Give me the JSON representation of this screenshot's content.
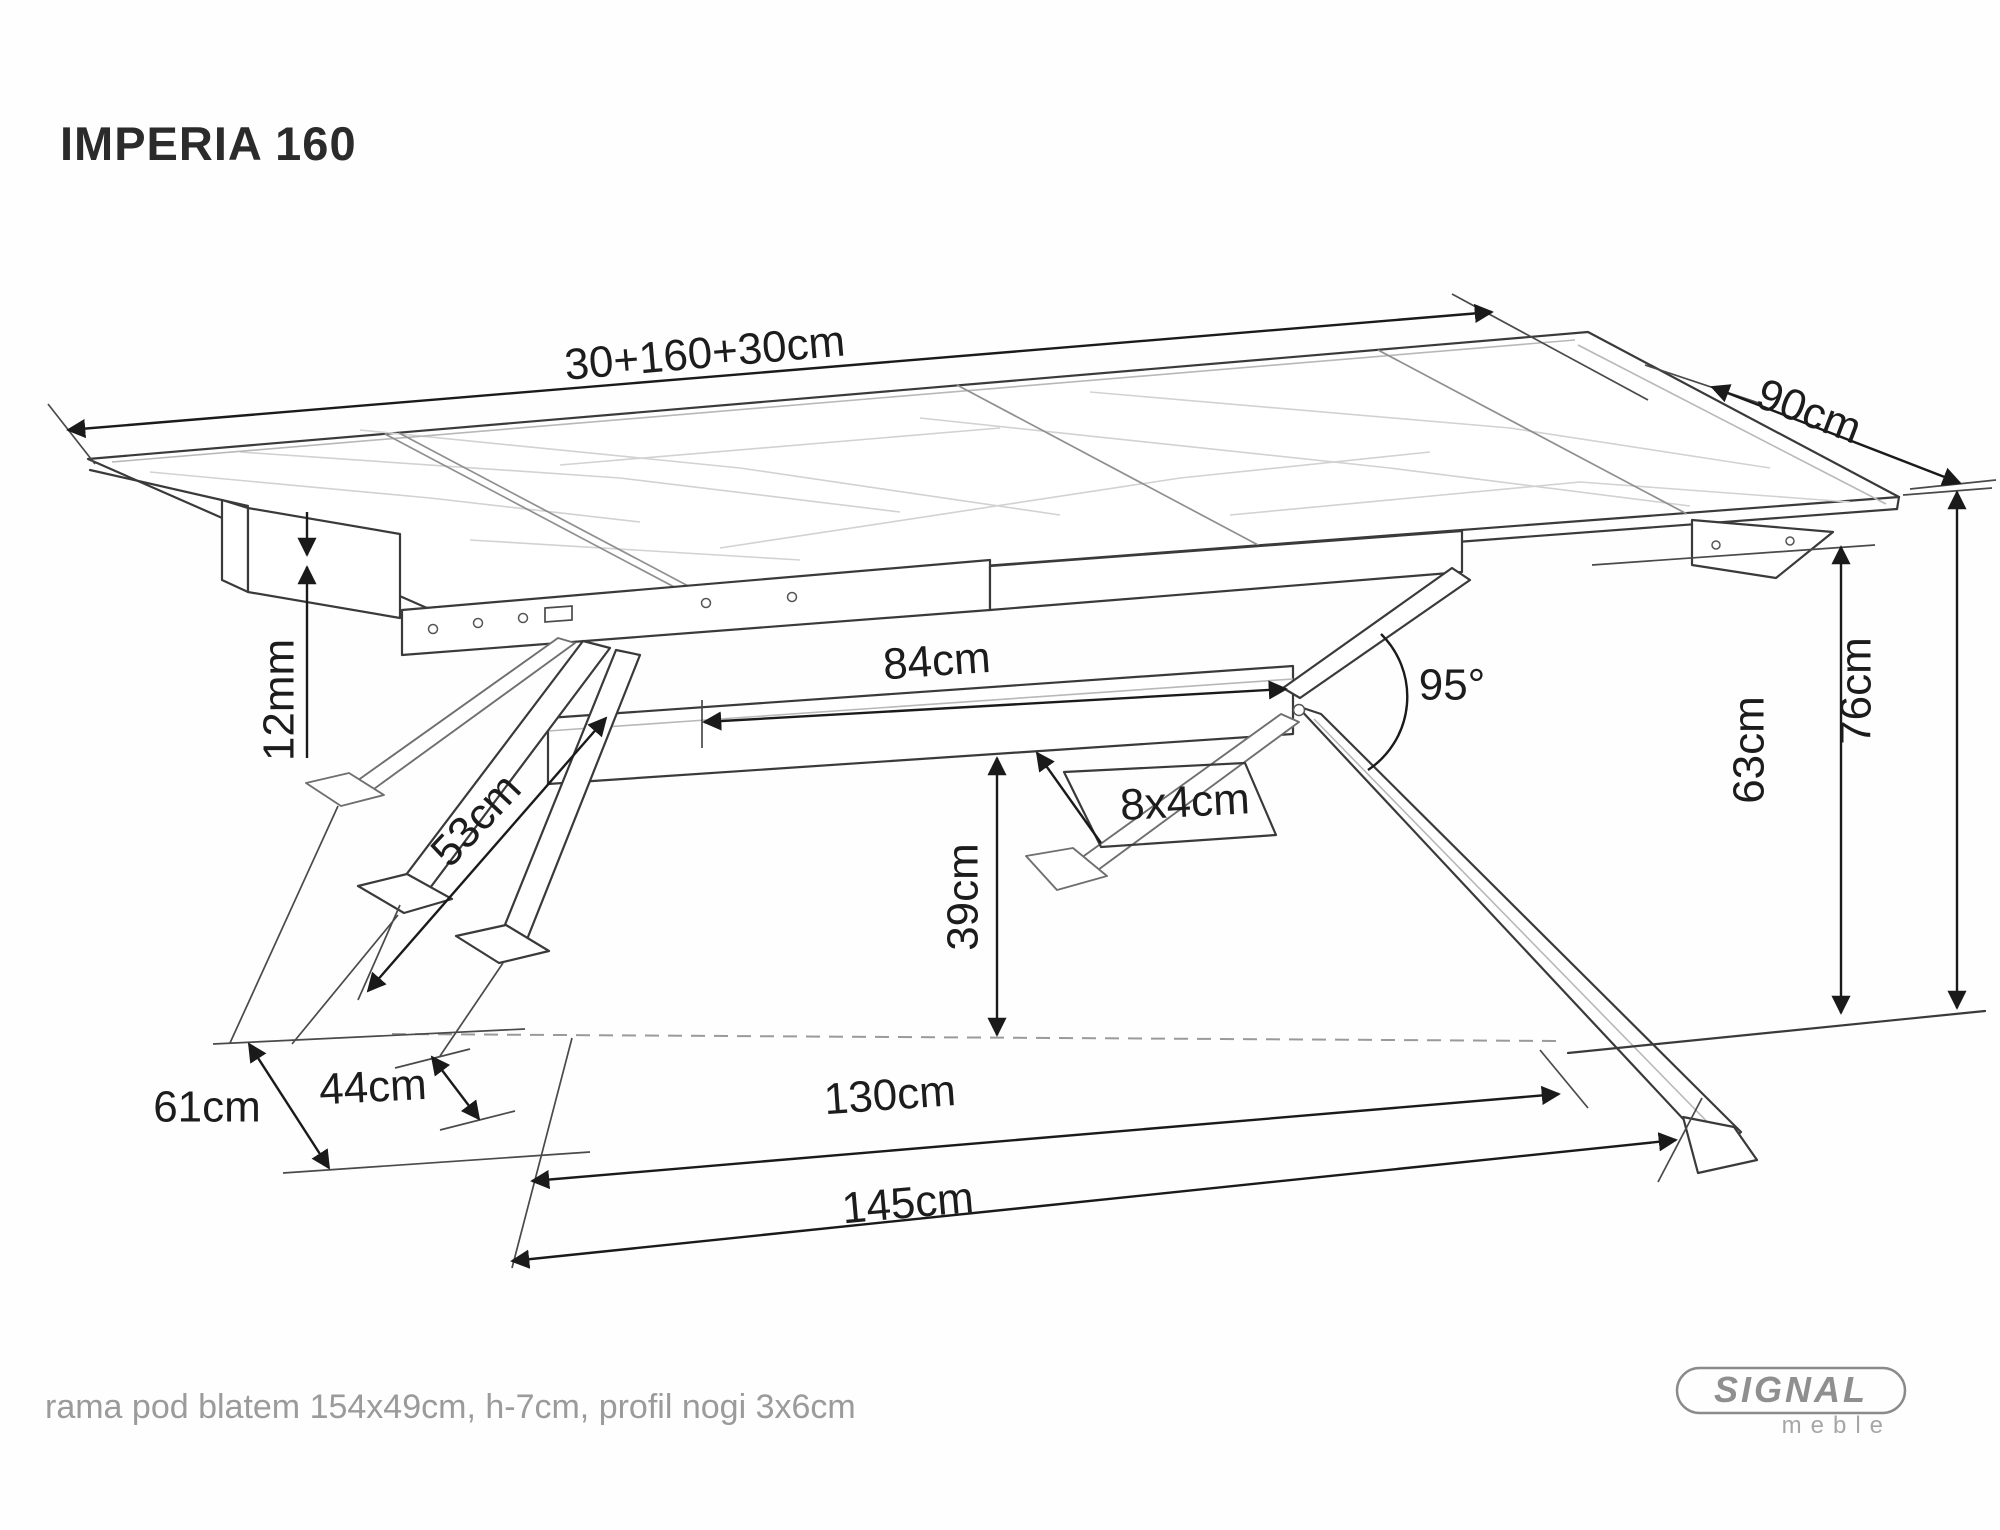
{
  "title": "IMPERIA 160",
  "footer": {
    "note": "rama pod blatem 154x49cm, h-7cm, profil nogi 3x6cm"
  },
  "logo": {
    "brand": "SIGNAL",
    "subbrand": "meble"
  },
  "dimensions": {
    "total_length": "30+160+30cm",
    "depth": "90cm",
    "beam_length": "84cm",
    "leg_angle": "95°",
    "beam_profile": "8x4cm",
    "top_thickness": "12mm",
    "strut_length": "53cm",
    "beam_floor_clearance": "39cm",
    "frame_clearance": "63cm",
    "table_height": "76cm",
    "foot_depth": "61cm",
    "foot_inset": "44cm",
    "feet_span_inner": "130cm",
    "feet_span_outer": "145cm"
  },
  "colors": {
    "drawing_line": "#3a3a3a",
    "dimension_line": "#1a1a1a",
    "marble_vein": "#d2d2d2",
    "muted_text": "#9b9b9b",
    "logo_gray": "#8f8f8f",
    "background": "#fefefe"
  }
}
